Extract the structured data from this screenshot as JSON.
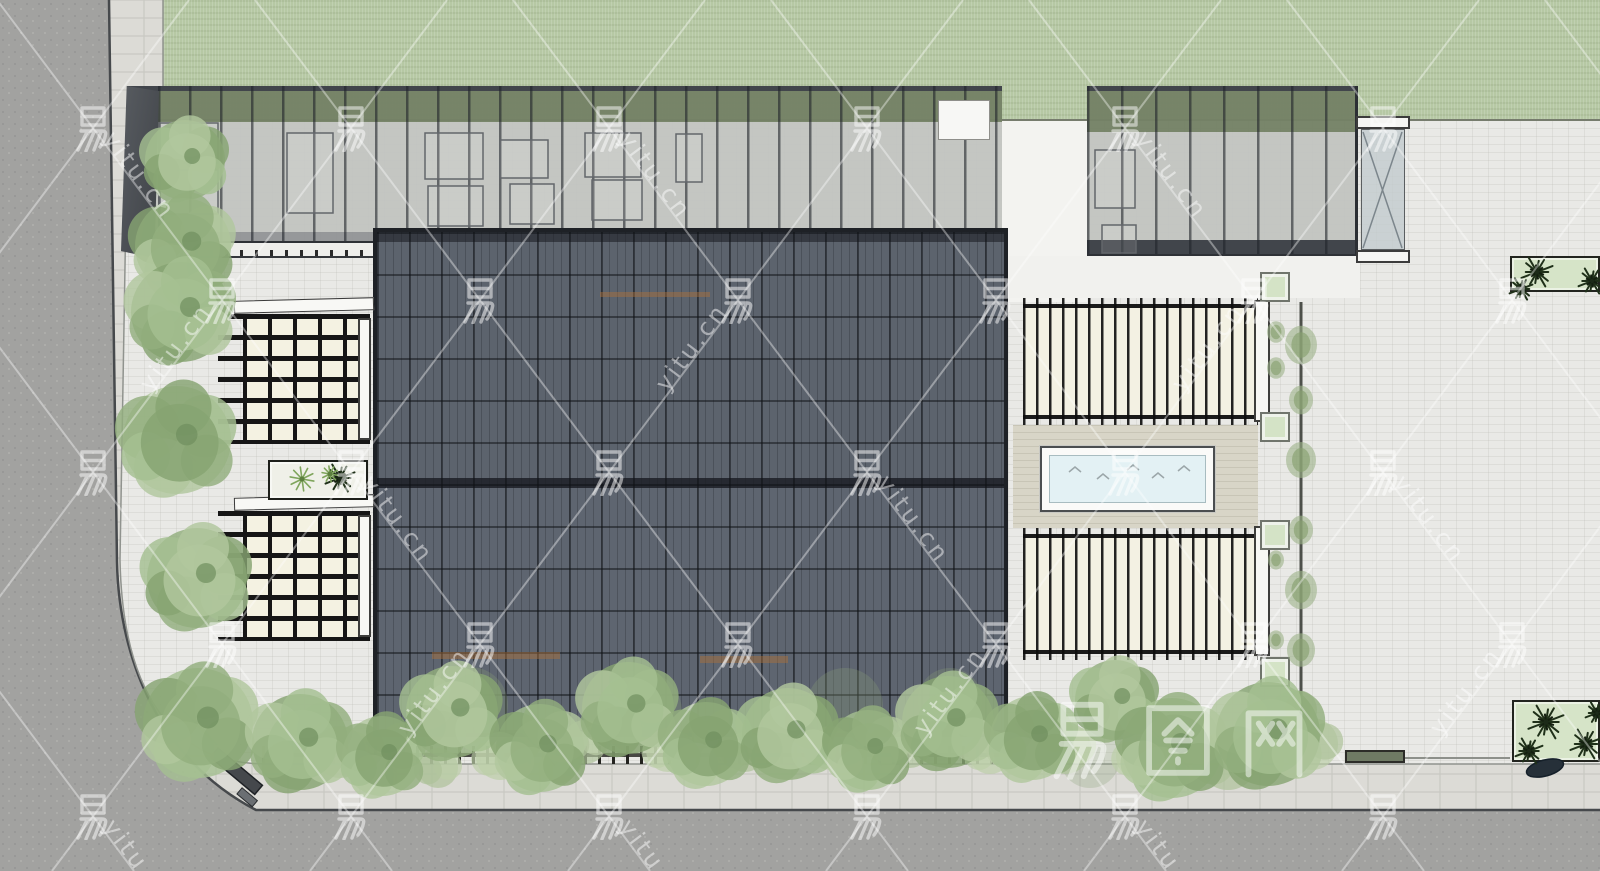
{
  "meta": {
    "kind": "architectural-site-plan-top-view",
    "render_style": "sketchup-colored-plan"
  },
  "watermark": {
    "char": "易",
    "url": "yitu.cn",
    "brand": "易图网",
    "color": "#ffffff",
    "line_opacity": 0.38,
    "glyph_opacity": 0.5,
    "text_opacity": 0.48,
    "lattice": {
      "x0": 93,
      "y0": 128,
      "dx": 129,
      "dy": 172
    },
    "brand_pos": {
      "x": 1042,
      "y": 698,
      "size": 80,
      "gap": 96
    }
  },
  "palette": {
    "road": "#a2a2a0",
    "sidewalk": "#dcdbd6",
    "plaza": "#e9e9e6",
    "grass": "#b6c8a4",
    "roof_dark": "#5d646d",
    "canopy_gray": "#b6b9b5",
    "pergola_cream": "#f4f2e2",
    "pool_water": "#e3f1f4",
    "planter_green": "#d4e3c6",
    "tree_greens": [
      "#93af7e",
      "#a5c091",
      "#86a471",
      "#b1c79e"
    ],
    "bush_greens": [
      "#aec29a",
      "#bccfa8"
    ],
    "dark_plant": "#1f3019",
    "curb_dark": "#46494c"
  },
  "site": {
    "green_squares": [
      [
        1260,
        272
      ],
      [
        1260,
        412
      ],
      [
        1260,
        520
      ],
      [
        1260,
        657
      ]
    ],
    "trees": [
      [
        185,
        160,
        40
      ],
      [
        183,
        246,
        48
      ],
      [
        181,
        312,
        50
      ],
      [
        177,
        440,
        54
      ],
      [
        197,
        578,
        50
      ],
      [
        198,
        723,
        55
      ],
      [
        300,
        742,
        48
      ],
      [
        382,
        756,
        40
      ],
      [
        452,
        712,
        46
      ],
      [
        540,
        748,
        44
      ],
      [
        628,
        708,
        46
      ],
      [
        706,
        744,
        42
      ],
      [
        788,
        734,
        46
      ],
      [
        868,
        750,
        40
      ],
      [
        948,
        722,
        46
      ],
      [
        1032,
        738,
        42
      ],
      [
        1115,
        700,
        40
      ],
      [
        1172,
        748,
        50
      ],
      [
        1268,
        734,
        52
      ]
    ],
    "bushes": [
      [
        340,
        752,
        26
      ],
      [
        500,
        756,
        24
      ],
      [
        585,
        742,
        22
      ],
      [
        668,
        750,
        22
      ],
      [
        745,
        752,
        20
      ],
      [
        830,
        748,
        22
      ],
      [
        910,
        748,
        20
      ],
      [
        990,
        752,
        22
      ],
      [
        1065,
        748,
        26
      ],
      [
        1140,
        756,
        24
      ],
      [
        1228,
        760,
        30
      ],
      [
        1312,
        744,
        26
      ],
      [
        438,
        768,
        20
      ],
      [
        560,
        765,
        18
      ]
    ],
    "hedge_blobs": [
      [
        1301,
        345,
        16
      ],
      [
        1301,
        400,
        12
      ],
      [
        1301,
        460,
        15
      ],
      [
        1301,
        530,
        12
      ],
      [
        1301,
        590,
        16
      ],
      [
        1301,
        650,
        14
      ],
      [
        1301,
        710,
        16
      ],
      [
        1276,
        332,
        9
      ],
      [
        1276,
        368,
        9
      ],
      [
        1276,
        560,
        8
      ],
      [
        1276,
        640,
        8
      ]
    ],
    "dark_plants": [
      [
        340,
        478,
        14
      ],
      [
        1537,
        272,
        15
      ],
      [
        1521,
        289,
        11
      ],
      [
        1592,
        281,
        13
      ],
      [
        1546,
        722,
        17
      ],
      [
        1529,
        751,
        13
      ],
      [
        1586,
        744,
        15
      ],
      [
        1597,
        713,
        11
      ]
    ],
    "grass_tufts": [
      [
        302,
        479,
        12
      ],
      [
        330,
        474,
        8
      ]
    ],
    "roof_ghosts": [
      [
        470,
        705,
        38
      ],
      [
        640,
        712,
        42
      ],
      [
        845,
        706,
        38
      ],
      [
        950,
        700,
        32
      ],
      [
        1090,
        758,
        30
      ]
    ],
    "wood_hints": [
      [
        432,
        652,
        128,
        7
      ],
      [
        700,
        656,
        88,
        7
      ],
      [
        600,
        292,
        110,
        5
      ]
    ],
    "furniture": [
      [
        160,
        123,
        58,
        40
      ],
      [
        160,
        170,
        58,
        44
      ],
      [
        287,
        133,
        46,
        80
      ],
      [
        425,
        133,
        58,
        46
      ],
      [
        428,
        186,
        55,
        40
      ],
      [
        500,
        140,
        48,
        38
      ],
      [
        510,
        184,
        44,
        40
      ],
      [
        585,
        133,
        56,
        44
      ],
      [
        592,
        180,
        50,
        40
      ],
      [
        676,
        134,
        26,
        48
      ],
      [
        1095,
        150,
        40,
        58
      ],
      [
        1102,
        225,
        34,
        28
      ]
    ],
    "pool_waves": [
      [
        1075,
        470
      ],
      [
        1103,
        477
      ],
      [
        1133,
        468
      ],
      [
        1158,
        476
      ],
      [
        1184,
        469
      ]
    ],
    "bench": [
      218,
      748,
      58,
      12,
      40
    ],
    "rock": [
      1545,
      768,
      38,
      16,
      -15
    ]
  }
}
